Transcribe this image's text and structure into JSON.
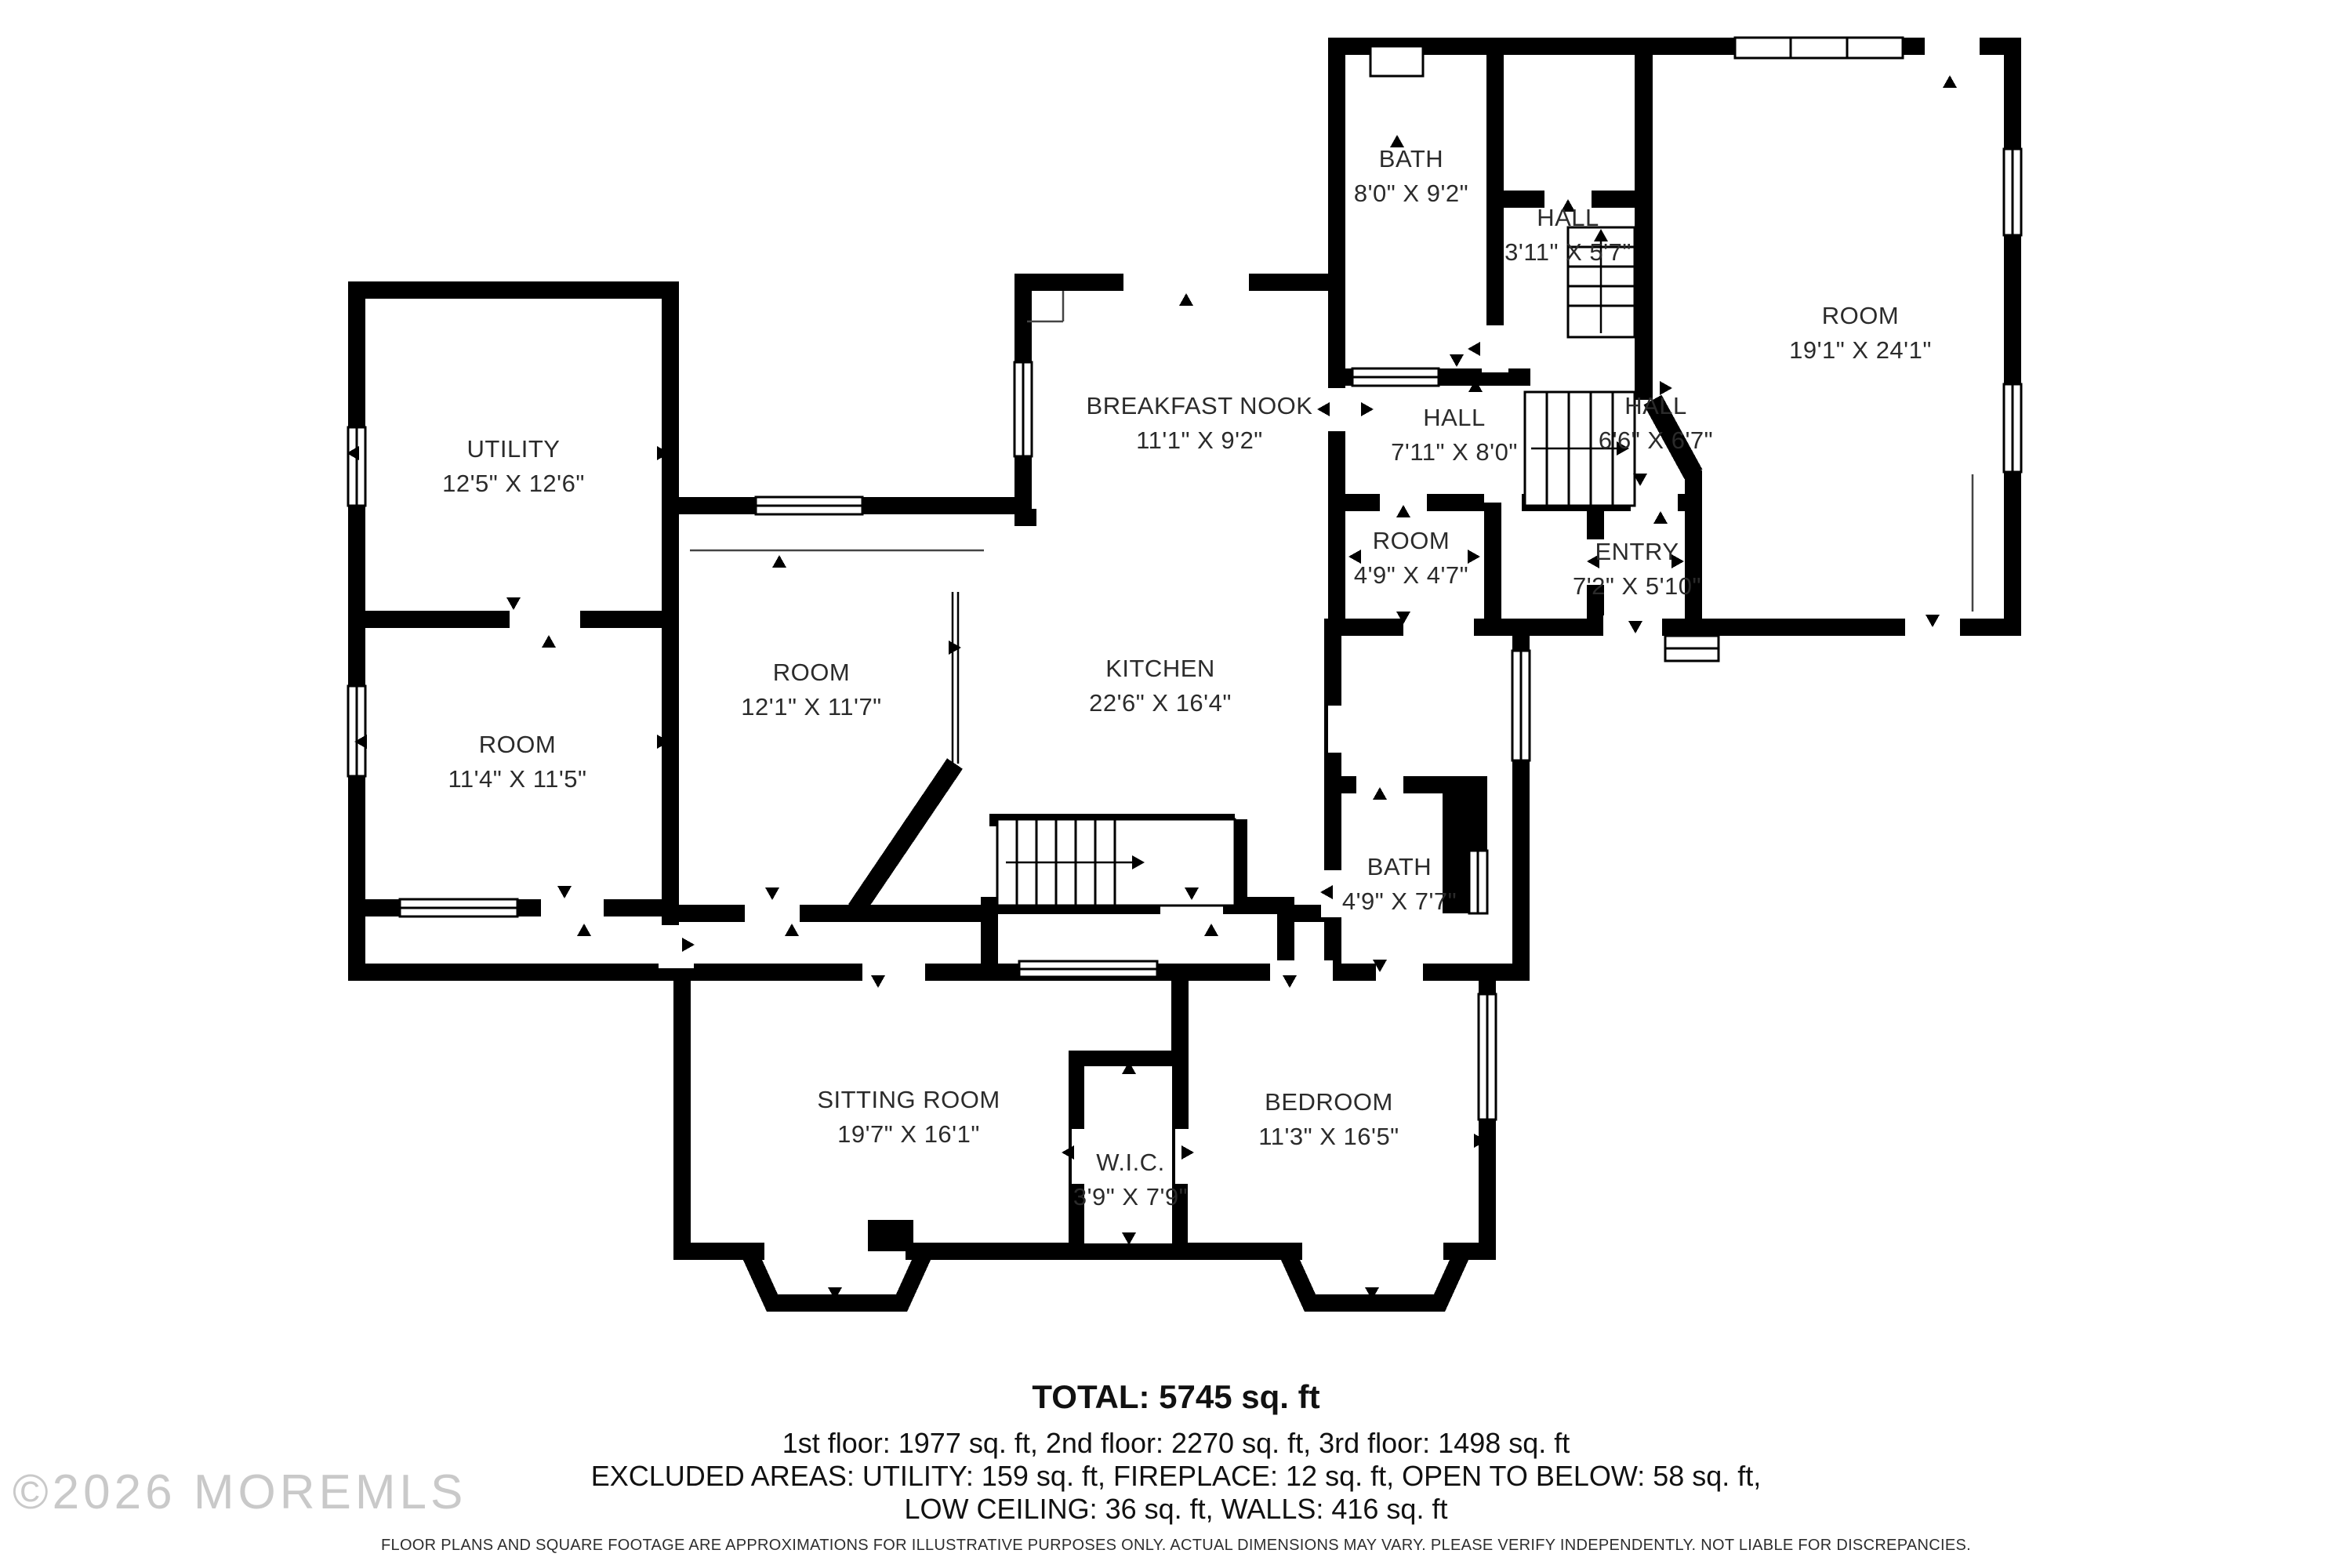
{
  "plan": {
    "rooms": [
      {
        "name": "BATH",
        "dims": "8'0\" X 9'2\""
      },
      {
        "name": "HALL",
        "dims": "3'11\" X 5'7\""
      },
      {
        "name": "ROOM",
        "dims": "19'1\" X 24'1\""
      },
      {
        "name": "BREAKFAST NOOK",
        "dims": "11'1\" X 9'2\""
      },
      {
        "name": "HALL",
        "dims": "7'11\" X 8'0\""
      },
      {
        "name": "HALL",
        "dims": "6'6\" X 6'7\""
      },
      {
        "name": "UTILITY",
        "dims": "12'5\" X 12'6\""
      },
      {
        "name": "ROOM",
        "dims": "12'1\" X 11'7\""
      },
      {
        "name": "KITCHEN",
        "dims": "22'6\" X 16'4\""
      },
      {
        "name": "ROOM",
        "dims": "4'9\" X 4'7\""
      },
      {
        "name": "ENTRY",
        "dims": "7'2\" X 5'10\""
      },
      {
        "name": "ROOM",
        "dims": "11'4\" X 11'5\""
      },
      {
        "name": "BATH",
        "dims": "4'9\" X 7'7\""
      },
      {
        "name": "SITTING ROOM",
        "dims": "19'7\" X 16'1\""
      },
      {
        "name": "W.I.C.",
        "dims": "3'9\" X 7'9\""
      },
      {
        "name": "BEDROOM",
        "dims": "11'3\" X 16'5\""
      }
    ]
  },
  "footer": {
    "total": "TOTAL: 5745 sq. ft",
    "floors": "1st floor: 1977 sq. ft, 2nd floor: 2270 sq. ft, 3rd floor: 1498 sq. ft",
    "excluded": "EXCLUDED AREAS: UTILITY: 159 sq. ft, FIREPLACE: 12 sq. ft, OPEN TO BELOW: 58 sq. ft,",
    "excluded2": "LOW CEILING: 36 sq. ft, WALLS: 416 sq. ft",
    "disclaimer": "FLOOR PLANS AND SQUARE FOOTAGE ARE APPROXIMATIONS FOR ILLUSTRATIVE PURPOSES ONLY. ACTUAL DIMENSIONS MAY VARY. PLEASE VERIFY INDEPENDENTLY. NOT LIABLE FOR DISCREPANCIES."
  },
  "watermark": "©2026 MOREMLS"
}
